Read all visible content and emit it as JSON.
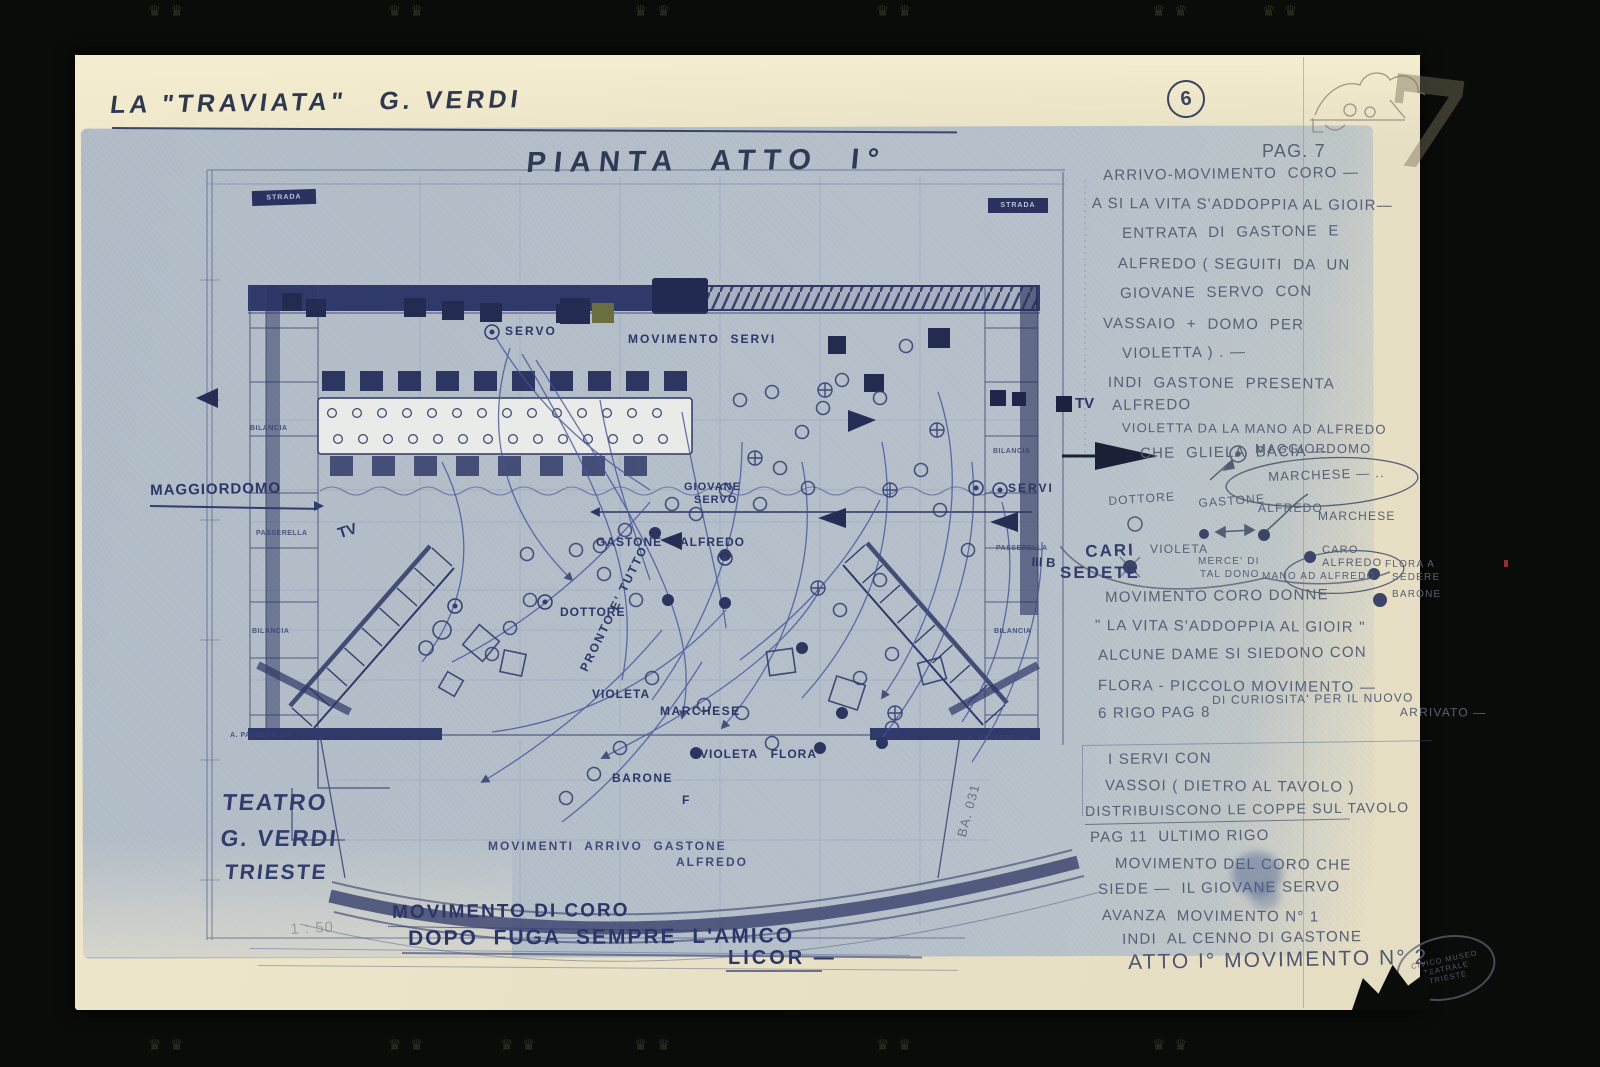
{
  "doc": {
    "title": "LA \"TRAVIATA\"   G. VERDI",
    "plan_title": "PIANTA  ATTO  I°",
    "page_circle": "6",
    "page_numeral": "7",
    "pag_heading": "PAG. 7",
    "theater": {
      "line1": "TEATRO",
      "line2": "G. VERDI",
      "line3": "TRIESTE"
    },
    "scale_note": "1 : 50"
  },
  "plan": {
    "labels": {
      "strada": "STRADA",
      "servo": "SERVO",
      "movimento_servi": "MOVIMENTO  SERVI",
      "maggiordomo": "MAGGIORDOMO",
      "tv": "TV",
      "giovane": "GIOVANE",
      "giovane2": "SERVO",
      "gastone": "GASTONE",
      "alfredo": "ALFREDO",
      "servi": "SERVI",
      "dottore": "DOTTORE",
      "pronto": "PRONTO E' TUTTO",
      "violeta": "VIOLETA",
      "marchese": "MARCHESE",
      "violeta_flora": "VIOLETA   FLORA",
      "barone": "BARONE",
      "f_mark": "F",
      "arrivo1": "MOVIMENTI  ARRIVO  GASTONE",
      "arrivo2": "ALFREDO",
      "bilancia": "BILANCIA",
      "passerella": "PASSERELLA",
      "a_passerella": "A. PASSERELLA",
      "tally": "III B",
      "ba_code": "BA. 031",
      "cari": "CARI",
      "sedete": "SEDETE"
    },
    "bottom_notes": {
      "mov_coro": "MOVIMENTO DI CORO",
      "dopo_fuga": "DOPO  FUGA  SEMPRE  L'AMICO",
      "licor": "LICOR —"
    }
  },
  "notes_column": {
    "top": [
      "ARRIVO-MOVIMENTO  CORO —",
      "A SI LA VITA S'ADDOPPIA AL GIOIR—",
      "ENTRATA  DI  GASTONE  E",
      "ALFREDO ( SEGUITI  DA  UN",
      "GIOVANE  SERVO  CON",
      "VASSAIO  +  DOMO  PER",
      "VIOLETTA ) . —",
      "INDI  GASTONE  PRESENTA",
      "ALFREDO",
      "VIOLETTA DA LA MANO AD ALFREDO",
      "CHE  GLIELA  BACIA —"
    ],
    "sketch": {
      "maggiordomo": "MAGGIORDOMO",
      "marchese_oval": "MARCHESE — ..",
      "dottore": "DOTTORE",
      "gastone": "GASTONE",
      "alfredo": "ALFREDO",
      "marchese": "MARCHESE",
      "caro": "CARO",
      "caro_alfredo": "ALFREDO",
      "violeta": "VIOLETA",
      "merce": "MERCE' DI",
      "tal_dono": "TAL DONO",
      "mano": "MANO AD ALFREDO",
      "flora_a": "FLORA A",
      "sedere": "SEDERE",
      "barone": "BARONE"
    },
    "mid": [
      "MOVIMENTO CORO DONNE",
      "\" LA VITA S'ADDOPPIA AL GIOIR \"",
      "ALCUNE DAME SI SIEDONO CON",
      "FLORA - PICCOLO MOVIMENTO —",
      "DI CURIOSITA' PER IL NUOVO",
      "ARRIVATO —",
      "6 RIGO PAG 8"
    ],
    "servi": [
      "I SERVI CON",
      "VASSOI ( DIETRO AL TAVOLO )",
      "DISTRIBUISCONO LE COPPE SUL TAVOLO"
    ],
    "bottom": [
      "PAG 11  ULTIMO RIGO",
      "MOVIMENTO DEL CORO CHE",
      "SIEDE —  IL GIOVANE SERVO",
      "AVANZA  MOVIMENTO N° 1",
      "INDI  AL CENNO DI GASTONE"
    ],
    "atto": "ATTO I° MOVIMENTO N° 2"
  },
  "stamp": {
    "line1": "CIVICO MUSEO",
    "line2": "TEATRALE",
    "line3": "TRIESTE"
  },
  "icons": {
    "crown_mark": "♛"
  },
  "colors": {
    "ink": "#2c3768",
    "pencil": "#575f74",
    "blueprint_paper": "#b6c1cb",
    "cream_paper": "#e9e1c5"
  }
}
